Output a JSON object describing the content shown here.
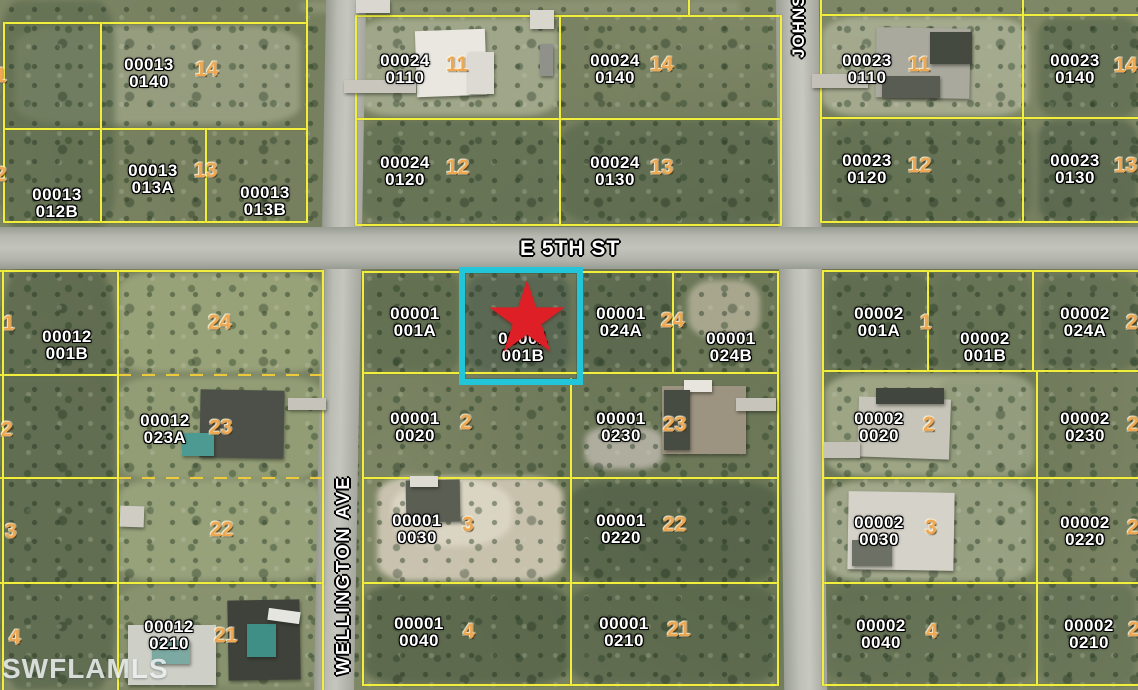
{
  "watermark": "SWFLAMLS",
  "streets": {
    "e5th": "E 5TH ST",
    "wellington": "WELLINGTON AVE",
    "johns": "JOHNS"
  },
  "highlight": {
    "parcel": "00001 001B",
    "star_glyph": "★",
    "box_color": "#23c6d8",
    "star_color": "#de2026"
  },
  "colors": {
    "boundary_line": "#f2ee3e",
    "boundary_dashed": "#ecca3c",
    "parcel_label": "#ffffff",
    "lot_number": "#efa852",
    "road": "#bcbeb6"
  },
  "parcel_labels": [
    {
      "l1": "00013",
      "l2": "0140",
      "x": 118,
      "y": 56
    },
    {
      "l1": "00013",
      "l2": "013A",
      "x": 122,
      "y": 162
    },
    {
      "l1": "00013",
      "l2": "013B",
      "x": 234,
      "y": 184
    },
    {
      "l1": "00013",
      "l2": "012B",
      "x": 26,
      "y": 186
    },
    {
      "l1": "00024",
      "l2": "0110",
      "x": 374,
      "y": 52
    },
    {
      "l1": "00024",
      "l2": "0140",
      "x": 584,
      "y": 52
    },
    {
      "l1": "00024",
      "l2": "0120",
      "x": 374,
      "y": 154
    },
    {
      "l1": "00024",
      "l2": "0130",
      "x": 584,
      "y": 154
    },
    {
      "l1": "00023",
      "l2": "0110",
      "x": 836,
      "y": 52
    },
    {
      "l1": "00023",
      "l2": "0140",
      "x": 1044,
      "y": 52
    },
    {
      "l1": "00023",
      "l2": "0120",
      "x": 836,
      "y": 152
    },
    {
      "l1": "00023",
      "l2": "0130",
      "x": 1044,
      "y": 152
    },
    {
      "l1": "00001",
      "l2": "001A",
      "x": 384,
      "y": 305
    },
    {
      "l1": "00001",
      "l2": "001B",
      "x": 492,
      "y": 330
    },
    {
      "l1": "00001",
      "l2": "024A",
      "x": 590,
      "y": 305
    },
    {
      "l1": "00001",
      "l2": "024B",
      "x": 700,
      "y": 330
    },
    {
      "l1": "00002",
      "l2": "001A",
      "x": 848,
      "y": 305
    },
    {
      "l1": "00002",
      "l2": "001B",
      "x": 954,
      "y": 330
    },
    {
      "l1": "00002",
      "l2": "024A",
      "x": 1054,
      "y": 305
    },
    {
      "l1": "00001",
      "l2": "0020",
      "x": 384,
      "y": 410
    },
    {
      "l1": "00001",
      "l2": "0230",
      "x": 590,
      "y": 410
    },
    {
      "l1": "00002",
      "l2": "0020",
      "x": 848,
      "y": 410
    },
    {
      "l1": "00002",
      "l2": "0230",
      "x": 1054,
      "y": 410
    },
    {
      "l1": "00001",
      "l2": "0030",
      "x": 386,
      "y": 512
    },
    {
      "l1": "00001",
      "l2": "0220",
      "x": 590,
      "y": 512
    },
    {
      "l1": "00002",
      "l2": "0030",
      "x": 848,
      "y": 514
    },
    {
      "l1": "00002",
      "l2": "0220",
      "x": 1054,
      "y": 514
    },
    {
      "l1": "00001",
      "l2": "0040",
      "x": 388,
      "y": 615
    },
    {
      "l1": "00001",
      "l2": "0210",
      "x": 593,
      "y": 615
    },
    {
      "l1": "00002",
      "l2": "0040",
      "x": 850,
      "y": 617
    },
    {
      "l1": "00002",
      "l2": "0210",
      "x": 1058,
      "y": 617
    },
    {
      "l1": "00012",
      "l2": "001B",
      "x": 36,
      "y": 328
    },
    {
      "l1": "00012",
      "l2": "023A",
      "x": 134,
      "y": 412
    },
    {
      "l1": "00012",
      "l2": "0210",
      "x": 138,
      "y": 618
    }
  ],
  "lot_numbers": [
    {
      "n": "14",
      "x": 195,
      "y": 60
    },
    {
      "n": "13",
      "x": 194,
      "y": 161
    },
    {
      "n": "11",
      "x": 446,
      "y": 55
    },
    {
      "n": "14",
      "x": 650,
      "y": 55
    },
    {
      "n": "12",
      "x": 446,
      "y": 158
    },
    {
      "n": "13",
      "x": 650,
      "y": 158
    },
    {
      "n": "11",
      "x": 908,
      "y": 55
    },
    {
      "n": "14",
      "x": 1114,
      "y": 56
    },
    {
      "n": "12",
      "x": 908,
      "y": 156
    },
    {
      "n": "13",
      "x": 1114,
      "y": 156
    },
    {
      "n": "1",
      "x": -5,
      "y": 66
    },
    {
      "n": "2",
      "x": -5,
      "y": 165
    },
    {
      "n": "24",
      "x": 208,
      "y": 313
    },
    {
      "n": "1",
      "x": 3,
      "y": 314
    },
    {
      "n": "23",
      "x": 209,
      "y": 418
    },
    {
      "n": "2",
      "x": 1,
      "y": 420
    },
    {
      "n": "22",
      "x": 210,
      "y": 520
    },
    {
      "n": "3",
      "x": 5,
      "y": 522
    },
    {
      "n": "21",
      "x": 214,
      "y": 626
    },
    {
      "n": "4",
      "x": 9,
      "y": 628
    },
    {
      "n": "24",
      "x": 661,
      "y": 311
    },
    {
      "n": "2",
      "x": 460,
      "y": 413
    },
    {
      "n": "23",
      "x": 663,
      "y": 415
    },
    {
      "n": "3",
      "x": 462,
      "y": 515
    },
    {
      "n": "22",
      "x": 663,
      "y": 515
    },
    {
      "n": "4",
      "x": 463,
      "y": 622
    },
    {
      "n": "21",
      "x": 667,
      "y": 620
    },
    {
      "n": "1",
      "x": 920,
      "y": 313
    },
    {
      "n": "24",
      "x": 1126,
      "y": 313
    },
    {
      "n": "2",
      "x": 923,
      "y": 415
    },
    {
      "n": "23",
      "x": 1127,
      "y": 415
    },
    {
      "n": "3",
      "x": 925,
      "y": 518
    },
    {
      "n": "22",
      "x": 1127,
      "y": 518
    },
    {
      "n": "4",
      "x": 926,
      "y": 622
    },
    {
      "n": "21",
      "x": 1128,
      "y": 620
    }
  ],
  "boundary_lines": [
    {
      "x": 3,
      "y": 22,
      "w": 305,
      "h": 2
    },
    {
      "x": 355,
      "y": 15,
      "w": 427,
      "h": 2
    },
    {
      "x": 820,
      "y": 14,
      "w": 318,
      "h": 2
    },
    {
      "x": 3,
      "y": 128,
      "w": 305,
      "h": 2
    },
    {
      "x": 355,
      "y": 118,
      "w": 427,
      "h": 2
    },
    {
      "x": 820,
      "y": 117,
      "w": 318,
      "h": 2
    },
    {
      "x": 3,
      "y": 221,
      "w": 305,
      "h": 2
    },
    {
      "x": 355,
      "y": 224,
      "w": 427,
      "h": 2
    },
    {
      "x": 820,
      "y": 221,
      "w": 318,
      "h": 2
    },
    {
      "x": 0,
      "y": 270,
      "w": 324,
      "h": 2
    },
    {
      "x": 362,
      "y": 271,
      "w": 417,
      "h": 2
    },
    {
      "x": 822,
      "y": 270,
      "w": 316,
      "h": 2
    },
    {
      "x": 0,
      "y": 374,
      "w": 118,
      "h": 2
    },
    {
      "x": 118,
      "y": 374,
      "w": 206,
      "h": 2,
      "d": 1
    },
    {
      "x": 362,
      "y": 372,
      "w": 417,
      "h": 2
    },
    {
      "x": 822,
      "y": 370,
      "w": 316,
      "h": 2
    },
    {
      "x": 0,
      "y": 477,
      "w": 118,
      "h": 2
    },
    {
      "x": 118,
      "y": 477,
      "w": 206,
      "h": 2,
      "d": 1
    },
    {
      "x": 362,
      "y": 477,
      "w": 417,
      "h": 2
    },
    {
      "x": 822,
      "y": 477,
      "w": 316,
      "h": 2
    },
    {
      "x": 0,
      "y": 582,
      "w": 324,
      "h": 2
    },
    {
      "x": 362,
      "y": 582,
      "w": 417,
      "h": 2
    },
    {
      "x": 822,
      "y": 582,
      "w": 316,
      "h": 2
    },
    {
      "x": 362,
      "y": 684,
      "w": 417,
      "h": 2
    },
    {
      "x": 822,
      "y": 684,
      "w": 316,
      "h": 2
    },
    {
      "x": 3,
      "y": 22,
      "w": 2,
      "h": 200
    },
    {
      "x": 100,
      "y": 22,
      "w": 2,
      "h": 200
    },
    {
      "x": 205,
      "y": 128,
      "w": 2,
      "h": 94
    },
    {
      "x": 306,
      "y": 0,
      "w": 2,
      "h": 222
    },
    {
      "x": 355,
      "y": 15,
      "w": 2,
      "h": 210
    },
    {
      "x": 559,
      "y": 15,
      "w": 2,
      "h": 210
    },
    {
      "x": 688,
      "y": 0,
      "w": 2,
      "h": 15
    },
    {
      "x": 780,
      "y": 15,
      "w": 2,
      "h": 210
    },
    {
      "x": 820,
      "y": 0,
      "w": 2,
      "h": 222
    },
    {
      "x": 1022,
      "y": 0,
      "w": 2,
      "h": 222
    },
    {
      "x": 2,
      "y": 270,
      "w": 2,
      "h": 420
    },
    {
      "x": 117,
      "y": 270,
      "w": 2,
      "h": 420
    },
    {
      "x": 322,
      "y": 270,
      "w": 2,
      "h": 420
    },
    {
      "x": 362,
      "y": 271,
      "w": 2,
      "h": 415
    },
    {
      "x": 570,
      "y": 378,
      "w": 2,
      "h": 308
    },
    {
      "x": 672,
      "y": 271,
      "w": 2,
      "h": 102
    },
    {
      "x": 777,
      "y": 271,
      "w": 2,
      "h": 415
    },
    {
      "x": 822,
      "y": 270,
      "w": 2,
      "h": 416
    },
    {
      "x": 927,
      "y": 271,
      "w": 2,
      "h": 100
    },
    {
      "x": 1032,
      "y": 271,
      "w": 2,
      "h": 100
    },
    {
      "x": 1036,
      "y": 371,
      "w": 2,
      "h": 315
    }
  ],
  "structures": [
    {
      "x": 416,
      "y": 30,
      "w": 70,
      "h": 66,
      "c": "#e9e7e0",
      "r": -2
    },
    {
      "x": 468,
      "y": 52,
      "w": 26,
      "h": 42,
      "c": "#dcdad2"
    },
    {
      "x": 344,
      "y": 80,
      "w": 72,
      "h": 13,
      "c": "#c8c6bd"
    },
    {
      "x": 530,
      "y": 10,
      "w": 24,
      "h": 19,
      "c": "#d9d6cd"
    },
    {
      "x": 540,
      "y": 44,
      "w": 13,
      "h": 32,
      "c": "#90918a"
    },
    {
      "x": 356,
      "y": 0,
      "w": 34,
      "h": 13,
      "c": "#d9d7cf"
    },
    {
      "x": 876,
      "y": 28,
      "w": 94,
      "h": 70,
      "c": "#aaa99e",
      "r": 1
    },
    {
      "x": 930,
      "y": 32,
      "w": 42,
      "h": 32,
      "c": "#454a40"
    },
    {
      "x": 882,
      "y": 76,
      "w": 58,
      "h": 22,
      "c": "#585c52"
    },
    {
      "x": 812,
      "y": 74,
      "w": 56,
      "h": 14,
      "c": "#c2c0b7"
    },
    {
      "x": 858,
      "y": 398,
      "w": 92,
      "h": 60,
      "c": "#c7c4b9",
      "r": 2
    },
    {
      "x": 876,
      "y": 388,
      "w": 68,
      "h": 16,
      "c": "#41463e"
    },
    {
      "x": 824,
      "y": 442,
      "w": 36,
      "h": 16,
      "c": "#c4c2b9"
    },
    {
      "x": 848,
      "y": 492,
      "w": 106,
      "h": 78,
      "c": "#d5d2c9",
      "r": 1
    },
    {
      "x": 852,
      "y": 540,
      "w": 40,
      "h": 26,
      "c": "#6d7165"
    },
    {
      "x": 662,
      "y": 386,
      "w": 84,
      "h": 68,
      "c": "#9d9381"
    },
    {
      "x": 684,
      "y": 380,
      "w": 28,
      "h": 12,
      "c": "#e7e5de"
    },
    {
      "x": 664,
      "y": 390,
      "w": 26,
      "h": 60,
      "c": "#474c42"
    },
    {
      "x": 736,
      "y": 398,
      "w": 40,
      "h": 13,
      "c": "#c6c4bb"
    },
    {
      "x": 406,
      "y": 480,
      "w": 54,
      "h": 42,
      "c": "#5b5e53",
      "r": -1
    },
    {
      "x": 410,
      "y": 476,
      "w": 28,
      "h": 11,
      "c": "#dedbd2"
    },
    {
      "x": 200,
      "y": 390,
      "w": 84,
      "h": 68,
      "c": "#4d5048",
      "r": 1
    },
    {
      "x": 288,
      "y": 398,
      "w": 38,
      "h": 12,
      "c": "#c5c3ba"
    },
    {
      "x": 182,
      "y": 433,
      "w": 32,
      "h": 23,
      "c": "#4d9a93"
    },
    {
      "x": 228,
      "y": 600,
      "w": 72,
      "h": 80,
      "c": "#3e423a",
      "r": -1
    },
    {
      "x": 247,
      "y": 624,
      "w": 29,
      "h": 33,
      "c": "#3f8f86"
    },
    {
      "x": 128,
      "y": 625,
      "w": 88,
      "h": 60,
      "c": "#ced0c7"
    },
    {
      "x": 152,
      "y": 640,
      "w": 38,
      "h": 24,
      "c": "#7ca9a1"
    },
    {
      "x": 268,
      "y": 610,
      "w": 32,
      "h": 12,
      "c": "#e6e6e0",
      "r": 8
    },
    {
      "x": 120,
      "y": 506,
      "w": 24,
      "h": 21,
      "c": "#cfccc4",
      "r": 2
    }
  ],
  "terrain_patches": [
    {
      "x": 15,
      "y": 26,
      "w": 285,
      "h": 98,
      "c": "#9aa183",
      "o": 0.9
    },
    {
      "x": 358,
      "y": 18,
      "w": 200,
      "h": 98,
      "c": "#a5ab8e",
      "o": 0.9
    },
    {
      "x": 822,
      "y": 17,
      "w": 206,
      "h": 99,
      "c": "#a9ae93",
      "o": 0.9
    },
    {
      "x": 300,
      "y": 0,
      "w": 440,
      "h": 14,
      "c": "#8f9677",
      "o": 0.8
    },
    {
      "x": 118,
      "y": 272,
      "w": 206,
      "h": 100,
      "c": "#9aa47b",
      "o": 0.95
    },
    {
      "x": 118,
      "y": 377,
      "w": 206,
      "h": 102,
      "c": "#95a078",
      "o": 0.9
    },
    {
      "x": 118,
      "y": 480,
      "w": 206,
      "h": 100,
      "c": "#9aa57e",
      "o": 0.9
    },
    {
      "x": 118,
      "y": 584,
      "w": 206,
      "h": 102,
      "c": "#8a9570",
      "o": 0.85
    },
    {
      "x": 825,
      "y": 374,
      "w": 208,
      "h": 102,
      "c": "#a3aa8a",
      "o": 0.9
    },
    {
      "x": 825,
      "y": 481,
      "w": 208,
      "h": 100,
      "c": "#a7ad90",
      "o": 0.9
    },
    {
      "x": 377,
      "y": 477,
      "w": 186,
      "h": 104,
      "c": "#cdc6b2",
      "o": 0.95
    },
    {
      "x": 392,
      "y": 480,
      "w": 120,
      "h": 66,
      "c": "#ddd7c6",
      "o": 0.9,
      "rd": 40
    },
    {
      "x": 585,
      "y": 427,
      "w": 78,
      "h": 42,
      "c": "#b7b3a6",
      "o": 0.9,
      "rd": 30
    },
    {
      "x": 688,
      "y": 280,
      "w": 72,
      "h": 58,
      "c": "#b3b098",
      "o": 0.85,
      "rd": 35
    },
    {
      "x": 0,
      "y": 0,
      "w": 115,
      "h": 230,
      "c": "#5a684c",
      "o": 0.6
    },
    {
      "x": 0,
      "y": 268,
      "w": 116,
      "h": 422,
      "c": "#4c5a42",
      "o": 0.55
    },
    {
      "x": 360,
      "y": 120,
      "w": 200,
      "h": 103,
      "c": "#5f6d51",
      "o": 0.6
    },
    {
      "x": 562,
      "y": 120,
      "w": 218,
      "h": 103,
      "c": "#57654b",
      "o": 0.6
    },
    {
      "x": 362,
      "y": 272,
      "w": 98,
      "h": 100,
      "c": "#566549",
      "o": 0.55
    },
    {
      "x": 576,
      "y": 272,
      "w": 100,
      "h": 100,
      "c": "#505f47",
      "o": 0.5
    },
    {
      "x": 466,
      "y": 274,
      "w": 104,
      "h": 98,
      "c": "#47584c",
      "o": 0.55
    },
    {
      "x": 570,
      "y": 482,
      "w": 208,
      "h": 100,
      "c": "#4b5a42",
      "o": 0.6
    },
    {
      "x": 364,
      "y": 584,
      "w": 204,
      "h": 100,
      "c": "#49583f",
      "o": 0.6
    },
    {
      "x": 570,
      "y": 584,
      "w": 206,
      "h": 100,
      "c": "#4e5d44",
      "o": 0.55
    },
    {
      "x": 826,
      "y": 584,
      "w": 208,
      "h": 100,
      "c": "#5e6b50",
      "o": 0.5
    },
    {
      "x": 1038,
      "y": 120,
      "w": 100,
      "h": 102,
      "c": "#4e5c46",
      "o": 0.6
    },
    {
      "x": 1038,
      "y": 17,
      "w": 100,
      "h": 100,
      "c": "#566449",
      "o": 0.55
    },
    {
      "x": 826,
      "y": 120,
      "w": 206,
      "h": 102,
      "c": "#5c6a4e",
      "o": 0.55
    },
    {
      "x": 826,
      "y": 274,
      "w": 104,
      "h": 96,
      "c": "#55644a",
      "o": 0.5
    },
    {
      "x": 933,
      "y": 274,
      "w": 100,
      "h": 96,
      "c": "#606e52",
      "o": 0.45
    },
    {
      "x": 1040,
      "y": 274,
      "w": 96,
      "h": 96,
      "c": "#58664c",
      "o": 0.5
    },
    {
      "x": 938,
      "y": 377,
      "w": 96,
      "h": 100,
      "c": "#8e9878",
      "o": 0.6
    },
    {
      "x": 938,
      "y": 480,
      "w": 96,
      "h": 100,
      "c": "#939d7d",
      "o": 0.6
    },
    {
      "x": 1040,
      "y": 584,
      "w": 96,
      "h": 102,
      "c": "#5a684e",
      "o": 0.5
    }
  ]
}
